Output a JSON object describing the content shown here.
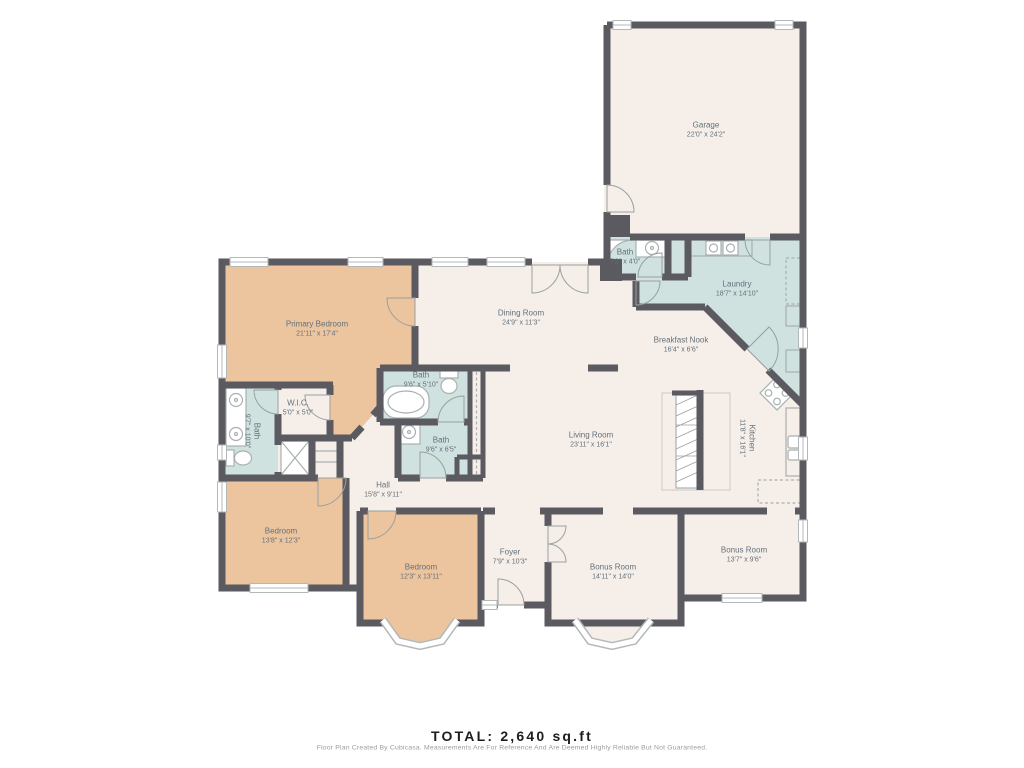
{
  "footer": {
    "total": "TOTAL: 2,640 sq.ft",
    "disclaimer": "Floor Plan Created By Cubicasa. Measurements Are For Reference And Are Deemed Highly Reliable But Not Guaranteed."
  },
  "colors": {
    "cream": "#f6efe9",
    "tan": "#ecc59e",
    "blue": "#cfe2e0",
    "wall": "#5a5a60",
    "label": "#63707b",
    "fixture": "#a9b0b0",
    "total_text": "#1d1d1b",
    "disclaimer_text": "#9b9b9b",
    "bg": "#ffffff"
  },
  "rooms": [
    {
      "name": "Garage",
      "dims": "22'0\" x 24'2\""
    },
    {
      "name": "Bath",
      "dims": "7'2\" x 4'0\""
    },
    {
      "name": "Laundry",
      "dims": "18'7\" x 14'10\""
    },
    {
      "name": "Dining Room",
      "dims": "24'9\" x 11'3\""
    },
    {
      "name": "Breakfast Nook",
      "dims": "16'4\" x 6'6\""
    },
    {
      "name": "Primary Bedroom",
      "dims": "21'11\" x 17'4\""
    },
    {
      "name": "W.I.C.",
      "dims": "5'0\" x 5'0\""
    },
    {
      "name": "Bath",
      "dims": "9'7\" x 10'0\""
    },
    {
      "name": "Bath",
      "dims": "9'6\" x 5'10\""
    },
    {
      "name": "Bath",
      "dims": "9'6\" x 6'5\""
    },
    {
      "name": "Living Room",
      "dims": "23'11\" x 16'1\""
    },
    {
      "name": "Kitchen",
      "dims": "11'8\" x 16'1\""
    },
    {
      "name": "Hall",
      "dims": "15'8\" x 9'11\""
    },
    {
      "name": "Bedroom",
      "dims": "13'8\" x 12'3\""
    },
    {
      "name": "Bedroom",
      "dims": "12'3\" x 13'11\""
    },
    {
      "name": "Foyer",
      "dims": "7'9\" x 10'3\""
    },
    {
      "name": "Bonus Room",
      "dims": "14'11\" x 14'0\""
    },
    {
      "name": "Bonus Room",
      "dims": "13'7\" x 9'6\""
    }
  ]
}
